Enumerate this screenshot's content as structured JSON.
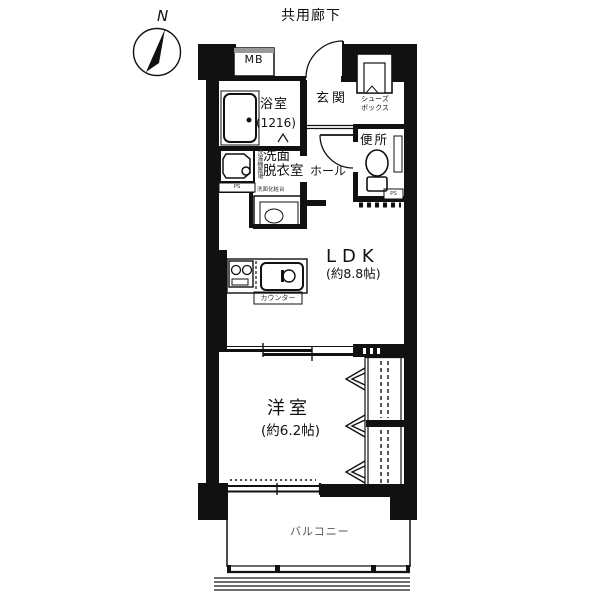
{
  "colors": {
    "wall": "#111111",
    "thin_line": "#1a1a1a",
    "balcony_lines": "#6e6e6e",
    "mb_top_bar": "#999999",
    "muted_text": "#333333",
    "balcony_text": "#555555"
  },
  "compass": {
    "north": "N"
  },
  "plan": {
    "corridor_label": "共用廊下",
    "meter_box": "MB",
    "rooms": {
      "bathroom": {
        "name": "浴室",
        "size": "(1216)"
      },
      "entrance": {
        "name": "玄関"
      },
      "shoe_box": {
        "line1": "シューズ",
        "line2": "ボックス"
      },
      "hall": {
        "name": "ホール"
      },
      "toilet": {
        "name": "便所"
      },
      "washroom": {
        "line1": "洗面",
        "line2": "脱衣室"
      },
      "ldk": {
        "name": "LDK",
        "size": "(約8.8帖)"
      },
      "western_room": {
        "name": "洋室",
        "size": "(約6.2帖)"
      },
      "balcony": {
        "name": "バルコニー"
      }
    },
    "fixtures": {
      "washing_machine": "洗濯機置場",
      "vanity": "洗面化粧台",
      "counter": "カウンター",
      "ps_washroom": "PS",
      "ps_toilet": "PS"
    }
  }
}
